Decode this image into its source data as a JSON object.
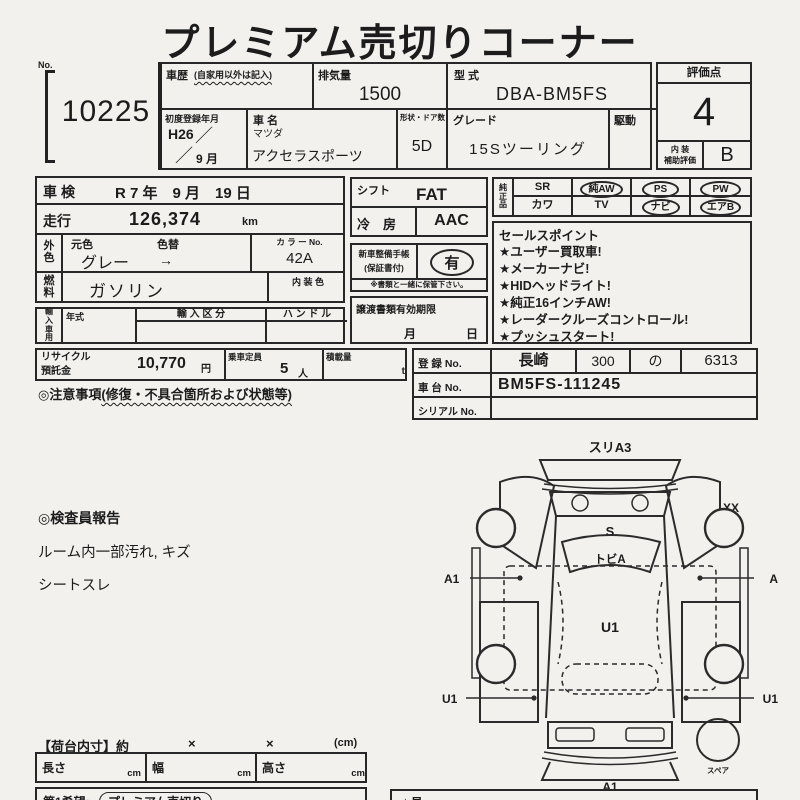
{
  "header": {
    "title": "プレミアム売切りコーナー"
  },
  "lot": {
    "no_label": "No.",
    "number": "10225"
  },
  "top_table": {
    "history_label": "車歴",
    "history_note": "(自家用以外は記入)",
    "history_value": "",
    "displacement_label": "排気量",
    "displacement_value": "1500",
    "model_code_label": "型 式",
    "model_code_value": "DBA-BM5FS",
    "first_reg_label": "初度登録年月",
    "first_reg_year": "H26",
    "slash": "／",
    "first_reg_month": "9 月",
    "car_name_label": "車 名",
    "maker": "マツダ",
    "car_name": "アクセラスポーツ",
    "shape_doors_label": "形状・ドア数",
    "shape_doors_value": "5D",
    "grade_label": "グレード",
    "grade_value": "15Sツーリング",
    "drive_label": "駆動",
    "drive_value": ""
  },
  "rating": {
    "label": "評価点",
    "score": "4",
    "interior_label_1": "内 装",
    "interior_label_2": "補助評価",
    "interior_score": "B"
  },
  "left_block": {
    "shaken_label": "車検",
    "shaken_value": "R 7 年　9 月　19 日",
    "mileage_label": "走行",
    "mileage_value": "126,374",
    "mileage_unit": "km",
    "color_label": "外色",
    "orig_color_label": "元色",
    "recolor_label": "色替",
    "orig_color_value": "グレー",
    "arrow": "→",
    "color_no_label": "カ ラ ー No.",
    "color_no_value": "42A",
    "fuel_label": "燃料",
    "fuel_value": "ガソリン",
    "interior_color_label": "内 装 色",
    "import_label": "輸入車用",
    "year_label": "年式",
    "import_class_label": "輸 入 区 分",
    "handle_label": "ハ ン ド ル"
  },
  "mid_block": {
    "shift_label": "シフト",
    "shift_value": "FAT",
    "ac_label": "冷　房",
    "ac_value": "AAC",
    "service_book_label_1": "新車整備手帳",
    "service_book_label_2": "(保証書付)",
    "service_book_value": "有",
    "service_book_note": "※書類と一緒に保管下さい。",
    "transfer_label": "譲渡書類有効期限",
    "month_label": "月",
    "day_label": "日"
  },
  "equipment": {
    "label": "純正品",
    "row1": [
      {
        "label": "SR",
        "circled": false
      },
      {
        "label": "純AW",
        "circled": true
      },
      {
        "label": "PS",
        "circled": true
      },
      {
        "label": "PW",
        "circled": true
      }
    ],
    "row2": [
      {
        "label": "カワ",
        "circled": false
      },
      {
        "label": "TV",
        "circled": false
      },
      {
        "label": "ナビ",
        "circled": true
      },
      {
        "label": "エアB",
        "circled": true
      }
    ]
  },
  "sales_points": {
    "label": "セールスポイント",
    "items": [
      "★ユーザー買取車!",
      "★メーカーナビ!",
      "★HIDヘッドライト!",
      "★純正16インチAW!",
      "★レーダークルーズコントロール!",
      "★プッシュスタート!"
    ]
  },
  "recycle": {
    "label_1": "リサイクル",
    "label_2": "預託金",
    "value": "10,770",
    "unit": "円",
    "capacity_label": "乗車定員",
    "capacity_value": "5",
    "capacity_unit": "人",
    "load_label": "積載量",
    "load_unit": "t"
  },
  "caution": {
    "prefix": "◎注意事項",
    "note": "(修復・不具合箇所および状態等)"
  },
  "registration": {
    "reg_label": "登 録 No.",
    "reg_area": "長崎",
    "reg_class": "300",
    "reg_kana": "の",
    "reg_number": "6313",
    "chassis_label": "車 台 No.",
    "chassis_value": "BM5FS-111245",
    "serial_label": "シリアル No.",
    "serial_value": ""
  },
  "inspector": {
    "title": "◎検査員報告",
    "lines": [
      "ルーム内一部汚れ, キズ",
      "シートスレ"
    ]
  },
  "diagram": {
    "labels": {
      "front_top": "スリA3",
      "hood": "S",
      "right_mirror": "XX",
      "windshield": "トビA",
      "left_front": "A1",
      "right_front": "A",
      "roof": "U1",
      "left_rear": "U1",
      "right_rear": "U1",
      "rear_bottom": "A1",
      "spare": "スペア"
    }
  },
  "cargo": {
    "title": "【荷台内寸】約",
    "x1": "×",
    "x2": "×",
    "unit": "(cm)",
    "length_label": "長さ",
    "width_label": "幅",
    "height_label": "高さ",
    "cm": "cm"
  },
  "footer": {
    "wish_label": "第1希望:",
    "wish_value": "プレミアム売切り",
    "right_fragment": "★見"
  }
}
